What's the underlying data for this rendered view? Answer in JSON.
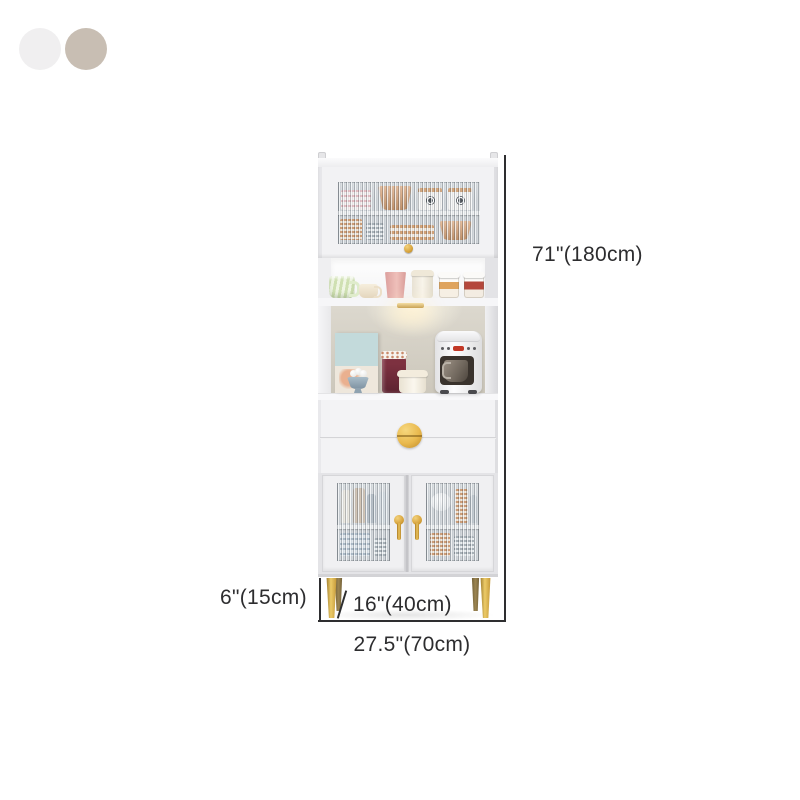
{
  "product": {
    "name": "tall-kitchen-hutch-cabinet",
    "swatches": [
      {
        "name": "white",
        "color": "#f0eff0"
      },
      {
        "name": "beige",
        "color": "#c8beb3"
      }
    ]
  },
  "dimensions": {
    "height": "71\"(180cm)",
    "leg_height": "6\"(15cm)",
    "depth": "16\"(40cm)",
    "width": "27.5\"(70cm)"
  },
  "style": {
    "annotation_color": "#2d2d2f",
    "accent_gold": "#d7a33c",
    "cabinet_white": "#f2f2f4",
    "glass_tint": "#ccd1d5",
    "hutch_back": "#d5d0c5",
    "background": "#ffffff"
  }
}
